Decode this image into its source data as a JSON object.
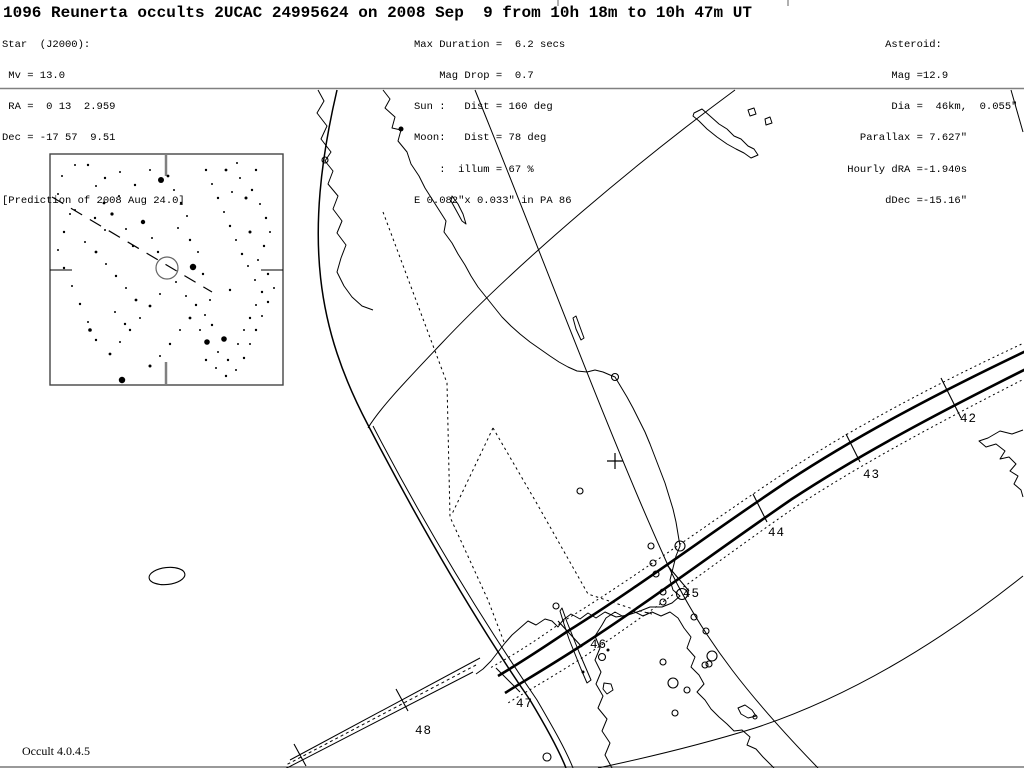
{
  "header": {
    "title": "1096 Reunerta occults 2UCAC 24995624 on 2008 Sep  9 from 10h 18m to 10h 47m UT",
    "star_block": [
      "Star  (J2000):",
      " Mv = 13.0",
      " RA =  0 13  2.959",
      "Dec = -17 57  9.51",
      "",
      "[Prediction of 2008 Aug 24.0]"
    ],
    "event_block": [
      "Max Duration =  6.2 secs",
      "    Mag Drop =  0.7",
      "Sun :   Dist = 160 deg",
      "Moon:   Dist = 78 deg",
      "    :  illum = 67 %",
      "E 0.082\"x 0.033\" in PA 86"
    ],
    "asteroid_block": [
      "       Asteroid:",
      "        Mag =12.9",
      "        Dia =  46km,  0.055\"",
      "   Parallax = 7.627\"",
      " Hourly dRA =-1.940s",
      "       dDec =-15.16\""
    ]
  },
  "footer": {
    "version": "Occult 4.0.4.5"
  },
  "colors": {
    "ink": "#000000",
    "gray": "#808080",
    "light_gray": "#b0b0b0",
    "chart_gray": "#666666"
  },
  "map": {
    "separator": {
      "y": 88.5
    },
    "bottom_edge_y": 767,
    "top_marks": [
      {
        "x": 557,
        "w": 2,
        "h": 6
      },
      {
        "x": 787,
        "w": 2,
        "h": 6
      }
    ],
    "curves": [
      {
        "name": "coastline-cape-york-west",
        "d": "M318,90 L324,101 L317,113 L327,126 L321,139 L331,152 L325,161 L333,171 L328,184 L338,196 L333,209 L342,221 L337,233 L346,245 L341,258 L337,272 L344,286 L352,297 L362,306 L373,310",
        "w": 1
      },
      {
        "name": "coastline-australia-east",
        "d": "M383,90 L390,99 L385,108 L395,117 L392,128 L401,130 L398,141 L407,152 L411,164 L419,176 L425,188 L432,199 L439,210 L446,221 L444,232 L452,243 L458,254 L465,265 L471,276 L478,287 L486,297 L494,307 L502,317 L511,326 L520,334 L530,342 L540,349 L550,356 L559,362 L568,367 L577,371 L587,372 L595,370 L603,372 L610,375 L615,377 L621,387 L627,397 L633,408 L639,420 L645,432 L650,444 L655,457 L660,470 L665,483 L669,496 L673,509 L676,522 L678,534 L680,546 L676,556 L673,568 L670,580 L673,590 L680,596 L672,603 L662,607 L650,607 L640,611 L628,615 L616,617 L605,612 L596,618 L588,613 L580,619 L571,614 L563,620 L558,627 L552,621 L545,619 L536,625 L528,621 L520,628 L512,635 L505,643 L498,652 L491,661 L483,669 L476,674",
        "w": 1
      },
      {
        "name": "island-fraser",
        "d": "M452,196 L458,204 L463,214 L466,224 L462,221 L456,210 L451,201 Z",
        "w": 1
      },
      {
        "name": "island-offshore-nsw",
        "d": "M576,316 L580,327 L584,338 L581,340 L576,329 L573,318 Z",
        "w": 1
      },
      {
        "name": "coastline-tasmania",
        "d": "M612,768 L605,755 L610,743 L602,731 L607,719 L598,708 L603,696 L596,684 L601,672 L595,660 L600,648 L595,636 L602,625 L606,618 L615,612 L624,617 L633,611 L643,616 L652,612 L661,616 L670,612 L678,618 L684,628 L691,637 L687,648 L695,657 L691,667 L699,675 L704,684 L697,692 L705,700 L711,709 L719,717 L727,724 L734,731 L742,730 L750,737 L747,745 L756,749 L763,757 L769,763 L774,768",
        "w": 1
      },
      {
        "name": "island-bass-strait-sliver",
        "d": "M562,608 L567,622 L573,637 L579,652 L585,666 L591,680 L587,683 L581,669 L575,654 L569,639 L564,624 L560,611 Z",
        "w": 1
      },
      {
        "name": "island-bass-strait-blob",
        "d": "M604,683 L611,684 L613,690 L607,694 L603,689 Z",
        "w": 1
      },
      {
        "name": "island-maria",
        "d": "M738,708 L745,705 L752,710 L756,716 L748,718 L741,714 Z",
        "w": 1
      },
      {
        "name": "coastline-new-zealand-fragment",
        "d": "M1023,430 L1012,434 L1000,431 L988,438 L979,441 L986,447 L996,444 L1005,451 L1000,459 L1009,457 L1016,464 L1010,471 L1018,476 L1014,484 L1021,490 L1023,497",
        "w": 1
      },
      {
        "name": "island-new-caledonia",
        "d": "M694,113 L702,109 L710,116 L719,124 L727,129 L734,136 L741,139 L748,146 L754,149 L758,155 L751,158 L744,153 L736,149 L727,144 L717,137 L707,129 L699,121 L693,116 Z",
        "w": 1
      },
      {
        "name": "islet-ne-1",
        "d": "M748,110 L754,108 L756,114 L750,116 Z",
        "w": 1
      },
      {
        "name": "islet-ne-2",
        "d": "M765,119 L770,117 L772,123 L766,125 Z",
        "w": 1
      },
      {
        "name": "limit-curve-star-altitude",
        "d": "M475,90 C540,250 605,425 662,552 C700,640 760,708 818,768",
        "w": 1
      },
      {
        "name": "limit-curve-west-main",
        "d": "M337,90 C302,240 318,330 368,425 C420,525 475,620 530,700 C545,725 558,748 566,768",
        "w": 1.5
      },
      {
        "name": "limit-curve-west-twin",
        "d": "M373,426 C425,526 483,621 537,700 C552,726 565,748 573,768",
        "w": 1
      },
      {
        "name": "limit-arc-upper-right",
        "d": "M735,90 C640,160 520,260 440,345 C405,382 380,408 368,428",
        "w": 1
      },
      {
        "name": "limit-arc-bottom-right",
        "d": "M1023,576 C930,650 840,700 755,728 C700,745 650,757 598,768",
        "w": 1
      },
      {
        "name": "limit-arc-top-corner",
        "d": "M1011,90 L1023,132",
        "w": 1
      },
      {
        "name": "state-border-west",
        "d": "M383,212 L447,383 L450,517 L488,600 L504,642",
        "w": 1,
        "dash": "2.5 3.2"
      },
      {
        "name": "state-border-murray-upper",
        "d": "M493,428 L452,514",
        "w": 1,
        "dash": "2.5 3.2"
      },
      {
        "name": "state-border-nsw-vic",
        "d": "M493,428 L536,502 L588,594 L636,610 L652,614",
        "w": 1,
        "dash": "2.5 3.2"
      },
      {
        "name": "path-limit-north-solid",
        "d": "M1026,351 C938,393 858,435 788,481 C713,531 640,586 568,631 C534,654 513,667 498,676",
        "w": 2.6
      },
      {
        "name": "path-limit-south-solid",
        "d": "M1026,369 C942,411 862,453 792,499 C719,549 646,604 576,649 C540,672 519,684 505,693",
        "w": 2.6
      },
      {
        "name": "path-uncertainty-north-dotted",
        "d": "M1026,342 C936,384 856,426 786,472 C710,522 636,577 562,622 C530,645 508,658 490,668",
        "w": 1,
        "dash": "2 3"
      },
      {
        "name": "path-uncertainty-south-dotted",
        "d": "M1026,378 C944,420 864,462 794,508 C722,558 650,613 582,658 C544,682 522,694 508,703",
        "w": 1,
        "dash": "2 3"
      },
      {
        "name": "path-extension-thin-north",
        "d": "M480,658 L290,760",
        "w": 1
      },
      {
        "name": "path-extension-thin-south",
        "d": "M473,672 L283,770",
        "w": 1
      },
      {
        "name": "path-extension-center-dashed",
        "d": "M476,665 L286,765",
        "w": 1,
        "dash": "3 3"
      }
    ],
    "time_ticks": [
      {
        "d": "M941,378 L961,418"
      },
      {
        "d": "M846,434 L860,462"
      },
      {
        "d": "M753,494 L767,522"
      },
      {
        "d": "M667,565 L689,591"
      },
      {
        "d": "M558,621 L582,647"
      },
      {
        "d": "M496,668 L520,692"
      },
      {
        "d": "M396,689 L408,711"
      },
      {
        "d": "M294,744 L306,766"
      }
    ],
    "tick_labels": [
      {
        "text": "42",
        "x": 960,
        "y": 422
      },
      {
        "text": "43",
        "x": 863,
        "y": 478
      },
      {
        "text": "44",
        "x": 768,
        "y": 536
      },
      {
        "text": "45",
        "x": 683,
        "y": 597
      },
      {
        "text": "46",
        "x": 590,
        "y": 648
      },
      {
        "text": "47",
        "x": 516,
        "y": 707
      },
      {
        "text": "48",
        "x": 415,
        "y": 734
      }
    ],
    "city_markers": [
      {
        "x": 682,
        "y": 594,
        "r": 5.5
      },
      {
        "x": 680,
        "y": 546,
        "r": 5
      },
      {
        "x": 712,
        "y": 656,
        "r": 5
      },
      {
        "x": 673,
        "y": 683,
        "r": 5
      },
      {
        "x": 547,
        "y": 757,
        "r": 4
      },
      {
        "x": 615,
        "y": 377,
        "r": 3.5
      },
      {
        "x": 602,
        "y": 657,
        "r": 3.5
      },
      {
        "x": 325,
        "y": 160,
        "r": 3
      },
      {
        "x": 651,
        "y": 546,
        "r": 3
      },
      {
        "x": 580,
        "y": 491,
        "r": 3
      },
      {
        "x": 653,
        "y": 563,
        "r": 3
      },
      {
        "x": 656,
        "y": 574,
        "r": 3
      },
      {
        "x": 663,
        "y": 592,
        "r": 3
      },
      {
        "x": 663,
        "y": 602,
        "r": 3
      },
      {
        "x": 694,
        "y": 617,
        "r": 3
      },
      {
        "x": 706,
        "y": 631,
        "r": 3
      },
      {
        "x": 709,
        "y": 664,
        "r": 3
      },
      {
        "x": 663,
        "y": 662,
        "r": 3
      },
      {
        "x": 556,
        "y": 606,
        "r": 3
      },
      {
        "x": 675,
        "y": 713,
        "r": 3
      },
      {
        "x": 687,
        "y": 690,
        "r": 3
      },
      {
        "x": 705,
        "y": 665,
        "r": 3
      },
      {
        "x": 755,
        "y": 717,
        "r": 2
      }
    ],
    "filled_dots": [
      {
        "x": 401,
        "y": 129,
        "r": 2.5
      },
      {
        "x": 583,
        "y": 672,
        "r": 1.5
      },
      {
        "x": 608,
        "y": 650,
        "r": 1.5
      }
    ],
    "site_cross": {
      "x": 615,
      "y": 461,
      "size": 16
    },
    "shadow_ellipse": {
      "cx": 167,
      "cy": 576,
      "rx": 18,
      "ry": 8.5,
      "rot": -6
    }
  },
  "finder_chart": {
    "box": {
      "x": 50,
      "y": 154,
      "w": 233,
      "h": 231
    },
    "edge_ticks": [
      {
        "d": "M166,154 L166,176",
        "w": 2.5,
        "gray": true
      },
      {
        "d": "M166,362 L166,384",
        "w": 2.5,
        "gray": true
      },
      {
        "d": "M50,270 L72,270",
        "w": 1,
        "gray": false
      },
      {
        "d": "M261,270 L283,270",
        "w": 1,
        "gray": false
      }
    ],
    "target_circle": {
      "x": 167,
      "y": 268,
      "r": 11
    },
    "motion_trail": {
      "d": "M52,197 L212,292",
      "dash": "13 9"
    },
    "stars": [
      {
        "x": 62,
        "y": 176,
        "r": 1
      },
      {
        "x": 75,
        "y": 210,
        "r": 1
      },
      {
        "x": 88,
        "y": 165,
        "r": 1.2
      },
      {
        "x": 96,
        "y": 186,
        "r": 1
      },
      {
        "x": 104,
        "y": 203,
        "r": 1.4
      },
      {
        "x": 112,
        "y": 214,
        "r": 1.6
      },
      {
        "x": 119,
        "y": 196,
        "r": 1
      },
      {
        "x": 126,
        "y": 229,
        "r": 1
      },
      {
        "x": 133,
        "y": 246,
        "r": 1.2
      },
      {
        "x": 143,
        "y": 222,
        "r": 2.2
      },
      {
        "x": 152,
        "y": 238,
        "r": 1
      },
      {
        "x": 158,
        "y": 252,
        "r": 1.2
      },
      {
        "x": 161,
        "y": 180,
        "r": 3
      },
      {
        "x": 168,
        "y": 176,
        "r": 1.4
      },
      {
        "x": 174,
        "y": 190,
        "r": 1
      },
      {
        "x": 181,
        "y": 203,
        "r": 1.2
      },
      {
        "x": 187,
        "y": 216,
        "r": 1
      },
      {
        "x": 178,
        "y": 228,
        "r": 1
      },
      {
        "x": 190,
        "y": 240,
        "r": 1.2
      },
      {
        "x": 198,
        "y": 252,
        "r": 1
      },
      {
        "x": 193,
        "y": 267,
        "r": 3.2
      },
      {
        "x": 203,
        "y": 274,
        "r": 1.2
      },
      {
        "x": 176,
        "y": 282,
        "r": 1
      },
      {
        "x": 186,
        "y": 296,
        "r": 1
      },
      {
        "x": 196,
        "y": 305,
        "r": 1.2
      },
      {
        "x": 205,
        "y": 315,
        "r": 1
      },
      {
        "x": 212,
        "y": 325,
        "r": 1.2
      },
      {
        "x": 207,
        "y": 342,
        "r": 2.8
      },
      {
        "x": 224,
        "y": 339,
        "r": 2.8
      },
      {
        "x": 218,
        "y": 352,
        "r": 1
      },
      {
        "x": 228,
        "y": 360,
        "r": 1.2
      },
      {
        "x": 238,
        "y": 344,
        "r": 1
      },
      {
        "x": 244,
        "y": 330,
        "r": 1
      },
      {
        "x": 250,
        "y": 318,
        "r": 1.2
      },
      {
        "x": 256,
        "y": 305,
        "r": 1
      },
      {
        "x": 262,
        "y": 292,
        "r": 1.2
      },
      {
        "x": 255,
        "y": 280,
        "r": 1
      },
      {
        "x": 248,
        "y": 266,
        "r": 1
      },
      {
        "x": 242,
        "y": 254,
        "r": 1.2
      },
      {
        "x": 236,
        "y": 240,
        "r": 1
      },
      {
        "x": 230,
        "y": 226,
        "r": 1.2
      },
      {
        "x": 224,
        "y": 212,
        "r": 1
      },
      {
        "x": 218,
        "y": 198,
        "r": 1.2
      },
      {
        "x": 212,
        "y": 184,
        "r": 1
      },
      {
        "x": 206,
        "y": 170,
        "r": 1.2
      },
      {
        "x": 226,
        "y": 170,
        "r": 1.4
      },
      {
        "x": 240,
        "y": 178,
        "r": 1
      },
      {
        "x": 252,
        "y": 190,
        "r": 1.2
      },
      {
        "x": 260,
        "y": 204,
        "r": 1
      },
      {
        "x": 266,
        "y": 218,
        "r": 1.2
      },
      {
        "x": 270,
        "y": 232,
        "r": 1
      },
      {
        "x": 264,
        "y": 246,
        "r": 1.2
      },
      {
        "x": 258,
        "y": 260,
        "r": 1
      },
      {
        "x": 268,
        "y": 274,
        "r": 1.2
      },
      {
        "x": 274,
        "y": 288,
        "r": 1
      },
      {
        "x": 268,
        "y": 302,
        "r": 1.2
      },
      {
        "x": 262,
        "y": 316,
        "r": 1
      },
      {
        "x": 256,
        "y": 330,
        "r": 1.2
      },
      {
        "x": 250,
        "y": 344,
        "r": 1
      },
      {
        "x": 244,
        "y": 358,
        "r": 1.2
      },
      {
        "x": 236,
        "y": 370,
        "r": 1
      },
      {
        "x": 226,
        "y": 376,
        "r": 1.2
      },
      {
        "x": 216,
        "y": 368,
        "r": 1
      },
      {
        "x": 206,
        "y": 360,
        "r": 1.2
      },
      {
        "x": 122,
        "y": 380,
        "r": 3.2
      },
      {
        "x": 96,
        "y": 340,
        "r": 1.2
      },
      {
        "x": 88,
        "y": 322,
        "r": 1
      },
      {
        "x": 80,
        "y": 304,
        "r": 1.2
      },
      {
        "x": 72,
        "y": 286,
        "r": 1
      },
      {
        "x": 64,
        "y": 268,
        "r": 1.2
      },
      {
        "x": 58,
        "y": 250,
        "r": 1
      },
      {
        "x": 64,
        "y": 232,
        "r": 1.2
      },
      {
        "x": 70,
        "y": 214,
        "r": 1
      },
      {
        "x": 58,
        "y": 194,
        "r": 1
      },
      {
        "x": 110,
        "y": 354,
        "r": 1.4
      },
      {
        "x": 120,
        "y": 342,
        "r": 1
      },
      {
        "x": 130,
        "y": 330,
        "r": 1.2
      },
      {
        "x": 140,
        "y": 318,
        "r": 1
      },
      {
        "x": 150,
        "y": 306,
        "r": 1.4
      },
      {
        "x": 160,
        "y": 294,
        "r": 1
      },
      {
        "x": 96,
        "y": 252,
        "r": 1.4
      },
      {
        "x": 106,
        "y": 264,
        "r": 1
      },
      {
        "x": 116,
        "y": 276,
        "r": 1.2
      },
      {
        "x": 126,
        "y": 288,
        "r": 1
      },
      {
        "x": 136,
        "y": 300,
        "r": 1.4
      },
      {
        "x": 75,
        "y": 165,
        "r": 1
      },
      {
        "x": 90,
        "y": 330,
        "r": 1.8
      },
      {
        "x": 150,
        "y": 366,
        "r": 1.5
      },
      {
        "x": 237,
        "y": 163,
        "r": 1
      },
      {
        "x": 256,
        "y": 170,
        "r": 1.2
      },
      {
        "x": 105,
        "y": 230,
        "r": 1
      },
      {
        "x": 95,
        "y": 218,
        "r": 1.2
      },
      {
        "x": 85,
        "y": 242,
        "r": 1
      },
      {
        "x": 115,
        "y": 312,
        "r": 1
      },
      {
        "x": 125,
        "y": 324,
        "r": 1.2
      },
      {
        "x": 250,
        "y": 232,
        "r": 1.5
      },
      {
        "x": 180,
        "y": 330,
        "r": 1
      },
      {
        "x": 170,
        "y": 344,
        "r": 1.2
      },
      {
        "x": 160,
        "y": 356,
        "r": 1
      },
      {
        "x": 190,
        "y": 318,
        "r": 1.4
      },
      {
        "x": 200,
        "y": 330,
        "r": 1
      },
      {
        "x": 210,
        "y": 300,
        "r": 1
      },
      {
        "x": 230,
        "y": 290,
        "r": 1.2
      },
      {
        "x": 150,
        "y": 170,
        "r": 1
      },
      {
        "x": 135,
        "y": 185,
        "r": 1.2
      },
      {
        "x": 120,
        "y": 172,
        "r": 1
      },
      {
        "x": 105,
        "y": 178,
        "r": 1.2
      },
      {
        "x": 246,
        "y": 198,
        "r": 1.5
      },
      {
        "x": 232,
        "y": 192,
        "r": 1
      }
    ]
  }
}
